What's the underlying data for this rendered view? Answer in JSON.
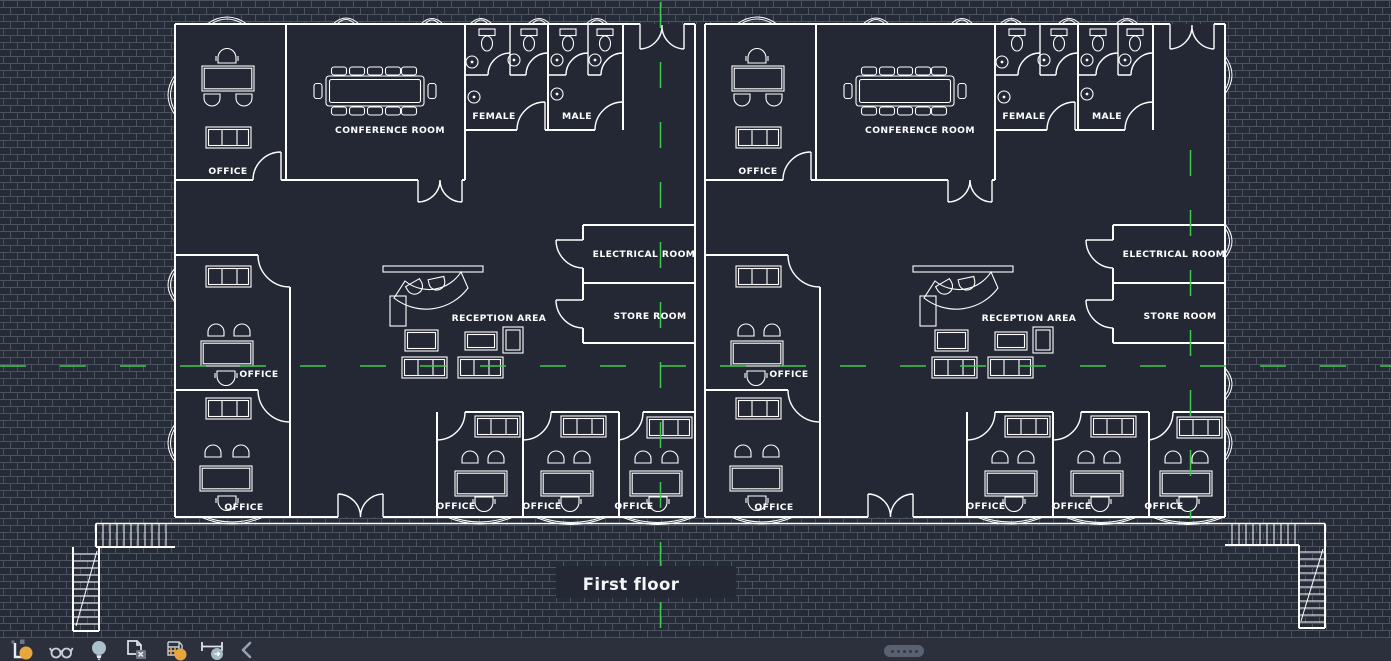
{
  "canvas": {
    "floor_title": "First floor"
  },
  "rooms": {
    "left": {
      "office_top": "OFFICE",
      "conference": "CONFERENCE ROOM",
      "female": "FEMALE",
      "male": "MALE",
      "electrical": "ELECTRICAL ROOM",
      "store": "STORE ROOM",
      "reception": "RECEPTION AREA",
      "office_mid": "OFFICE",
      "office_bottom": "OFFICE",
      "office_c1": "OFFICE",
      "office_c2": "OFFICE",
      "office_c3": "OFFICE"
    },
    "right": {
      "office_top": "OFFICE",
      "conference": "CONFERENCE ROOM",
      "female": "FEMALE",
      "male": "MALE",
      "electrical": "ELECTRICAL ROOM",
      "store": "STORE ROOM",
      "reception": "RECEPTION AREA",
      "office_mid": "OFFICE",
      "office_bottom": "OFFICE",
      "office_c1": "OFFICE",
      "office_c2": "OFFICE",
      "office_c3": "OFFICE"
    }
  },
  "toolbar": {
    "icons": [
      {
        "name": "layout-plot-icon"
      },
      {
        "name": "glasses-view-icon"
      },
      {
        "name": "lightbulb-icon"
      },
      {
        "name": "sheets-copy-icon"
      },
      {
        "name": "model-3d-icon"
      },
      {
        "name": "measure-dimension-icon"
      },
      {
        "name": "chevron-left-icon"
      }
    ]
  },
  "colors": {
    "background_brick": "#262b38",
    "brick_mortar": "#4b5260",
    "plan_fill": "#232834",
    "line_white": "#ffffff",
    "centerline_green": "#3ec94f",
    "toolbar_bg": "#2b303c",
    "icon_orange": "#e9a63f",
    "icon_blue_gray": "#a4bbc7",
    "icon_light": "#d5dae2",
    "handle_gray": "#5a6170"
  }
}
